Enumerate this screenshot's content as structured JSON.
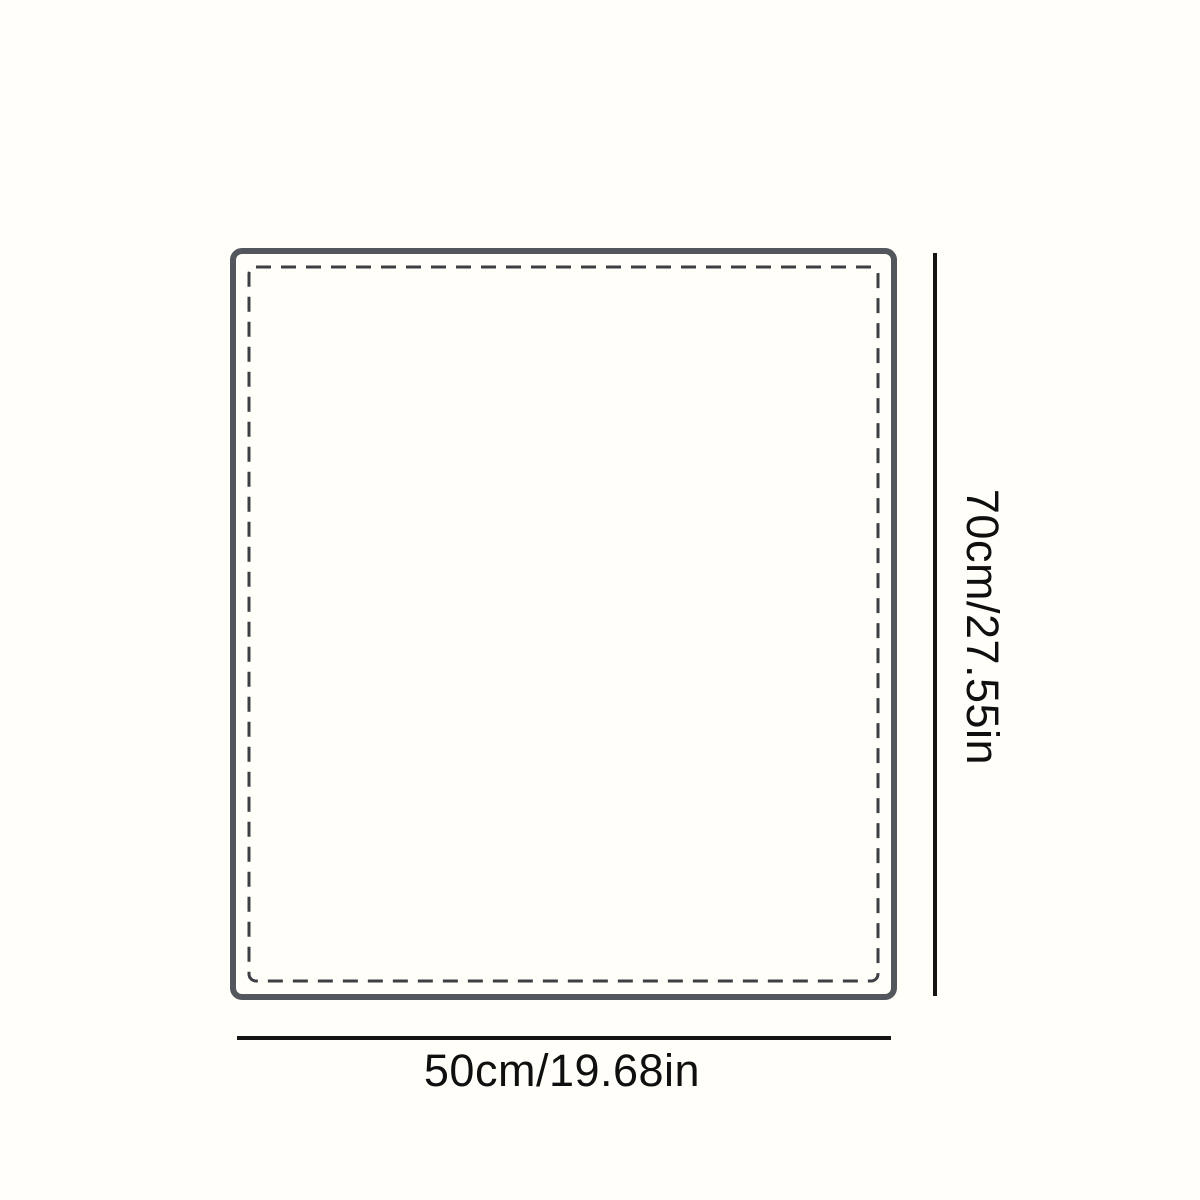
{
  "diagram": {
    "height_label": "70cm/27.55in",
    "width_label": "50cm/19.68in"
  },
  "colors": {
    "background": "#FFFEF8",
    "rect_border": "#53565C",
    "dashed_border": "#3C3F44",
    "dimension_line": "#141414",
    "label_text": "#0F0F0F"
  }
}
